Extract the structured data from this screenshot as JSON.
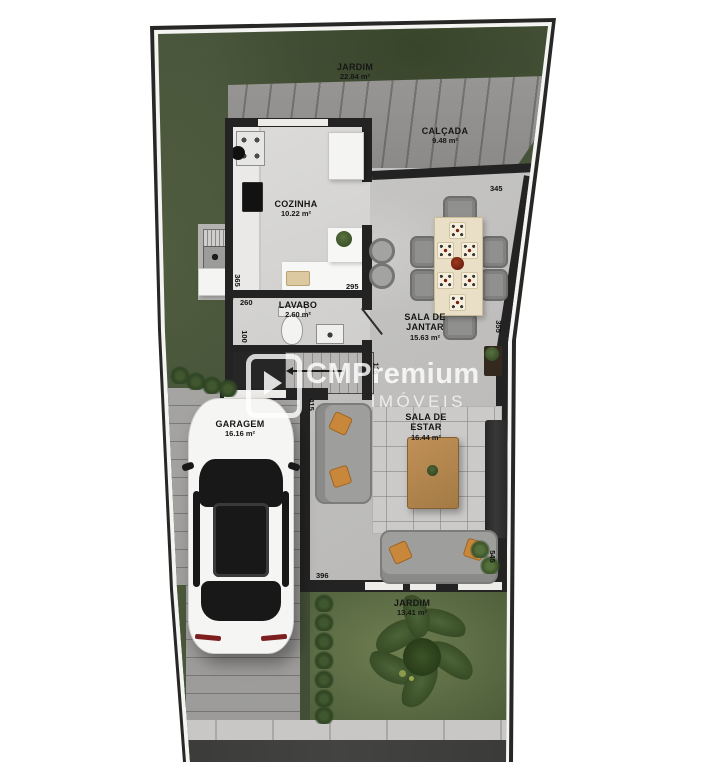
{
  "watermark": {
    "brand": "CMPremium",
    "subtitle": "IMÓVEIS"
  },
  "rooms": {
    "jardim_top": {
      "name": "JARDIM",
      "area": "22.84 m²"
    },
    "calcada": {
      "name": "CALÇADA",
      "area": "9.48 m²"
    },
    "cozinha": {
      "name": "COZINHA",
      "area": "10.22 m²"
    },
    "lavabo": {
      "name": "LAVABO",
      "area": "2.60 m²"
    },
    "sala_jantar": {
      "name": "SALA DE JANTAR",
      "area": "15.63 m²"
    },
    "sala_estar": {
      "name": "SALA DE ESTAR",
      "area": "16.44 m²"
    },
    "garagem": {
      "name": "GARAGEM",
      "area": "16.16 m²"
    },
    "jardim_bottom": {
      "name": "JARDIM",
      "area": "13.41 m²"
    }
  },
  "dimensions": {
    "dining_top": "345",
    "dining_right": "355",
    "island_right": "295",
    "lavabo_width": "260",
    "lavabo_depth": "100",
    "kitchen_left": "365",
    "living_bottom": "396",
    "living_left": "415",
    "living_right": "545",
    "stair_side": "116"
  },
  "colors": {
    "grass": "#47543a",
    "grass_light": "#6f7e50",
    "concrete_walkway": "#8e8d8b",
    "pavers": "#a3a2a0",
    "wall": "#232323",
    "floor_kitchen": "#d6d5d3",
    "floor_social": "#c1c0be",
    "counter_white": "#f6f6f4",
    "table_wood": "#e9dfc6",
    "coffee_table_wood": "#b5854e",
    "pillow_orange": "#c9873c",
    "street_asphalt": "#3d3d3c",
    "car_body": "#f5f5f4"
  }
}
